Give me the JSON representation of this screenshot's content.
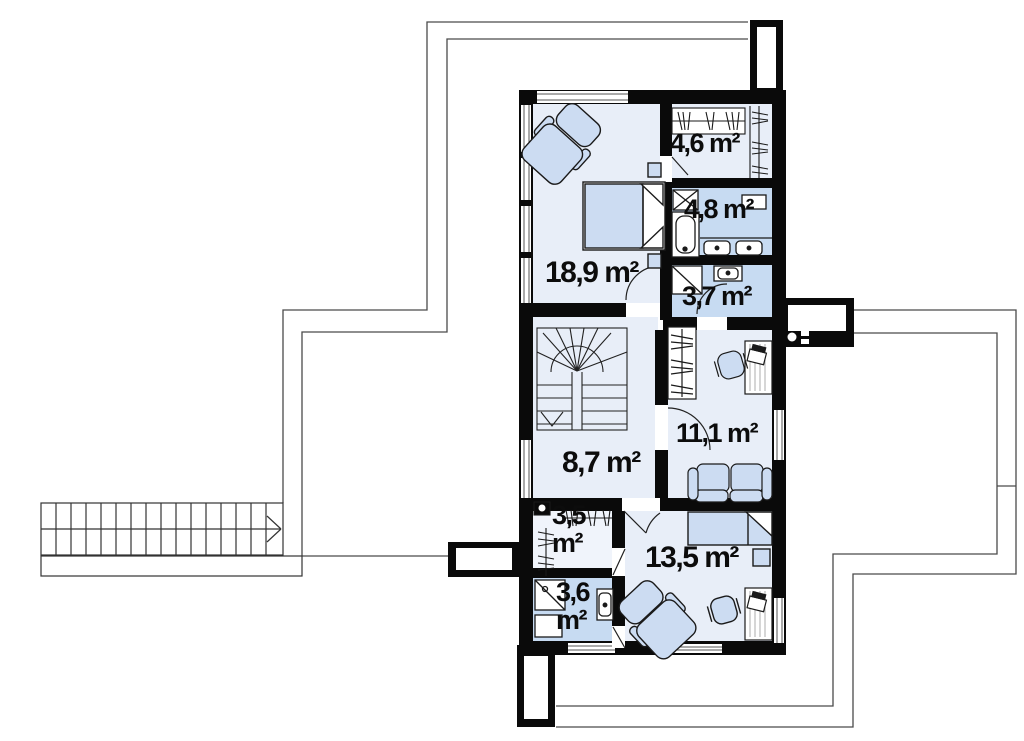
{
  "plan": {
    "type": "second-floor-plan",
    "rooms": [
      {
        "id": "bedroom-main",
        "area_label": "18,9 m²"
      },
      {
        "id": "wardrobe",
        "area_label": "4,6 m²"
      },
      {
        "id": "bathroom-main",
        "area_label": "4,8 m²"
      },
      {
        "id": "shower-room",
        "area_label": "3,7 m²"
      },
      {
        "id": "hall-stairs",
        "area_label": "8,7 m²"
      },
      {
        "id": "office",
        "area_label": "11,1 m²"
      },
      {
        "id": "walkin-closet",
        "area_label": "3,5 m²"
      },
      {
        "id": "bathroom-small",
        "area_label": "3,6 m²"
      },
      {
        "id": "bedroom-second",
        "area_label": "13,5 m²"
      }
    ],
    "colors": {
      "wall": "#0a0a0a",
      "floor_light": "#e8eef8",
      "floor_bath": "#c7dbf2",
      "furniture_fill": "#ccdcf2",
      "outline_thin": "#4a4a4a",
      "paper": "#ffffff"
    }
  }
}
